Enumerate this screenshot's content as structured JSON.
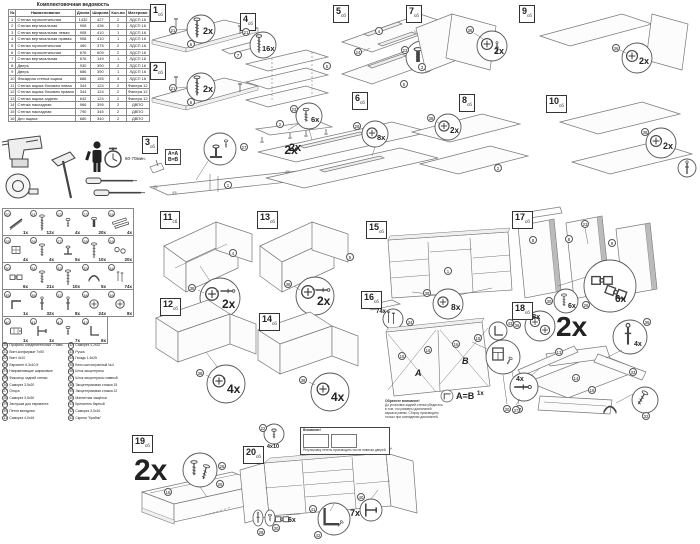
{
  "doc": {
    "table": {
      "title": "Комплектовочная ведомость",
      "columns": [
        "№",
        "Наименование",
        "Длина",
        "Ширина",
        "Кол-во",
        "Материал"
      ],
      "rows": [
        [
          "1",
          "Стенка горизонтальная",
          "1432",
          "427",
          "2",
          "ЛДСП 16"
        ],
        [
          "2",
          "Стенка вертикальная",
          "908",
          "436",
          "2",
          "ЛДСП 16"
        ],
        [
          "3",
          "Стенка вертикальная левая",
          "908",
          "410",
          "1",
          "ЛДСП 16"
        ],
        [
          "4",
          "Стенка вертикальная правая",
          "908",
          "410",
          "1",
          "ЛДСП 16"
        ],
        [
          "5",
          "Стенка горизонтальная",
          "460",
          "375",
          "2",
          "ЛДСП 16"
        ],
        [
          "6",
          "Стенка горизонтальная",
          "676",
          "609",
          "2",
          "ЛДСП 16"
        ],
        [
          "7",
          "Стенка вертикальная",
          "676",
          "149",
          "1",
          "ЛДСП 16"
        ],
        [
          "8",
          "Дверь",
          "930",
          "390",
          "2",
          "ЛДСП 16"
        ],
        [
          "9",
          "Дверь",
          "686",
          "390",
          "1",
          "ЛДСП 16"
        ],
        [
          "10",
          "Фасадная стенка ящика",
          "686",
          "155",
          "3",
          "ЛДСП 16"
        ],
        [
          "11",
          "Стенка ящика боковая левая",
          "344",
          "124",
          "2",
          "Фанера 12"
        ],
        [
          "12",
          "Стенка ящика боковая правая",
          "344",
          "124",
          "2",
          "Фанера 12"
        ],
        [
          "13",
          "Стенка ящика задняя",
          "642",
          "124",
          "2",
          "Фанера 12"
        ],
        [
          "14",
          "Стенка накладная",
          "966",
          "395",
          "2",
          "ДВПО"
        ],
        [
          "15",
          "Стенка накладная",
          "790",
          "345",
          "2",
          "ДВПО"
        ],
        [
          "16",
          "Дно ящика",
          "680",
          "340",
          "2",
          "ДВПО"
        ]
      ]
    },
    "tools": {
      "time": "60-70мин."
    },
    "hardware": [
      {
        "num": "20",
        "qty": "1x",
        "icon": "rod",
        "name": "Профиль соединительный 776мм."
      },
      {
        "num": "21",
        "qty": "12x",
        "icon": "confirmat",
        "name": "Винт-конфирмат 7х50"
      },
      {
        "num": "22",
        "qty": "4x",
        "icon": "screw-small",
        "name": "Винт 4х10"
      },
      {
        "num": "23",
        "qty": "20x",
        "icon": "euro",
        "name": "Евровинт 6,3х10,5"
      },
      {
        "num": "24",
        "qty": "4x",
        "icon": "rails",
        "name": "Направляющие шариковые"
      },
      {
        "num": "25",
        "qty": "4x",
        "icon": "block",
        "name": "Фиксатор задней стенки"
      },
      {
        "num": "26",
        "qty": "4x",
        "icon": "screw",
        "name": "Саморез 3,5х20"
      },
      {
        "num": "27",
        "qty": "5x",
        "icon": "foot",
        "name": "Опора"
      },
      {
        "num": "28",
        "qty": "10x",
        "icon": "screw-long",
        "name": "Саморез 3,5х30"
      },
      {
        "num": "29",
        "qty": "20x",
        "icon": "caps",
        "name": "Заглушка для евровинта"
      },
      {
        "num": "30",
        "qty": "6x",
        "icon": "hinge",
        "name": "Петля вкладная"
      },
      {
        "num": "31",
        "qty": "21x",
        "icon": "screw",
        "name": "Саморез 4,0х16"
      },
      {
        "num": "32",
        "qty": "10x",
        "icon": "screw-long",
        "name": "Саморез 4,2х32"
      },
      {
        "num": "33",
        "qty": "5x",
        "icon": "handle",
        "name": "Ручка"
      },
      {
        "num": "34",
        "qty": "74x",
        "icon": "nails",
        "name": "Гвоздь 1,6х25"
      },
      {
        "num": "35",
        "qty": "1x",
        "icon": "hexkey",
        "name": "Ключ шестигранный №4"
      },
      {
        "num": "36",
        "qty": "32x",
        "icon": "pin",
        "name": "Шток эксцентрика"
      },
      {
        "num": "37",
        "qty": "8x",
        "icon": "pin",
        "name": "Шток эксцентрика главный"
      },
      {
        "num": "38",
        "qty": "24x",
        "icon": "cam",
        "name": "Эксцентриковая стяжка 15"
      },
      {
        "num": "39",
        "qty": "8x",
        "icon": "cam",
        "name": "Эксцентриковая стяжка 12"
      },
      {
        "num": "40",
        "qty": "1x",
        "icon": "latch",
        "name": "Магнитная защёлка"
      },
      {
        "num": "41",
        "qty": "1x",
        "icon": "bracket",
        "name": "Крепитель барный"
      },
      {
        "num": "42",
        "qty": "7x",
        "icon": "screw-small",
        "name": "Саморез 3,0х16"
      },
      {
        "num": "43",
        "qty": "6x",
        "icon": "angle",
        "name": "Скрепа \"Крабик\""
      }
    ],
    "steps_sub": "сб",
    "steps": {
      "s1": {
        "num": "1",
        "qty": "2x",
        "refs": {
          "screw": "21",
          "panel_a": "6",
          "panel_b": "7"
        }
      },
      "s2": {
        "num": "2",
        "qty": "2x",
        "refs": {
          "screw": "21",
          "panel": "6"
        }
      },
      "s3": {
        "num": "3",
        "aa": "A=A",
        "bb": "B=B",
        "qty": "2x",
        "refs": {
          "panel": "1",
          "panel2": "2",
          "foot": "27"
        }
      },
      "s4": {
        "num": "4",
        "qty": "16x",
        "refs": {
          "screw": "21",
          "panel": "5"
        }
      },
      "s5": {
        "num": "5",
        "qty": "8x",
        "refs": {
          "panel_a": "4",
          "panel_b": "5",
          "rail": "24",
          "euro": "23"
        }
      },
      "s6": {
        "num": "6",
        "qty_a": "6x",
        "qty_b": "8x",
        "qty_c": "2x",
        "refs": {
          "euro": "23",
          "screw": "28"
        }
      },
      "s7": {
        "num": "7",
        "qty": "2x",
        "refs": {
          "cam": "36",
          "panel": "3"
        }
      },
      "s8": {
        "num": "8",
        "qty": "2x",
        "refs": {
          "cam": "38",
          "panel": "2"
        }
      },
      "s9": {
        "num": "9",
        "qty": "2x",
        "refs": {
          "cam": "36"
        }
      },
      "s10": {
        "num": "10",
        "qty": "2x",
        "refs": {
          "cam": "38"
        }
      },
      "s11": {
        "num": "11",
        "qty": "2x",
        "refs": {
          "cam": "38",
          "panel": "4"
        }
      },
      "s12": {
        "num": "12",
        "qty": "4x",
        "refs": {
          "cam": "38"
        }
      },
      "s13": {
        "num": "13",
        "qty": "2x",
        "refs": {
          "cam": "38",
          "panel": "5"
        }
      },
      "s14": {
        "num": "14",
        "qty": "4x",
        "refs": {
          "cam": "38"
        }
      },
      "s15": {
        "num": "15",
        "qty": "8x",
        "refs": {
          "cam": "38",
          "panel": "1"
        }
      },
      "s16": {
        "num": "16",
        "nails_qty": "74x",
        "a": "A",
        "b": "B",
        "ab": "A=B",
        "one": "1x",
        "note_title": "Обратите внимание!",
        "note": "До установки задней стенки убедитесь в том, что размеры диагоналей каркаса равны. Сборку производить только при совпадении диагоналей.",
        "refs": {
          "nail": "34",
          "clip": "43",
          "p15": "15",
          "p16": "16",
          "p16b": "16",
          "p15b": "15",
          "p30": "30",
          "p37": "37"
        }
      },
      "s17": {
        "num": "17",
        "qty_a": "6x",
        "qty_b": "6x",
        "refs": {
          "euro": "23",
          "d1": "8",
          "d2": "8",
          "d3": "9",
          "hinge": "30",
          "screw": "26"
        }
      },
      "s18": {
        "num": "18",
        "big": "2x",
        "qty_a": "8x",
        "qty_b": "4x",
        "qty_c": "4x",
        "refs": {
          "cam_a": "36",
          "cam_b": "36",
          "rod": "37",
          "handle": "33",
          "screw": "32",
          "p13": "13",
          "p14": "14",
          "p16": "16"
        }
      },
      "s19": {
        "num": "19",
        "big": "2x",
        "refs": {
          "screw": "26",
          "fix": "25",
          "panel": "16"
        }
      },
      "s20": {
        "num": "20",
        "screw_size": "4x10",
        "qty_hinge": "6x",
        "qty_clip": "7x",
        "note_title": "Внимание!",
        "note": "Регулировку петель производить после навески дверей.",
        "refs": {
          "screw": "22",
          "latch": "40",
          "rail": "41",
          "clip": "42",
          "hinge": "30",
          "fix": "28"
        }
      }
    }
  }
}
